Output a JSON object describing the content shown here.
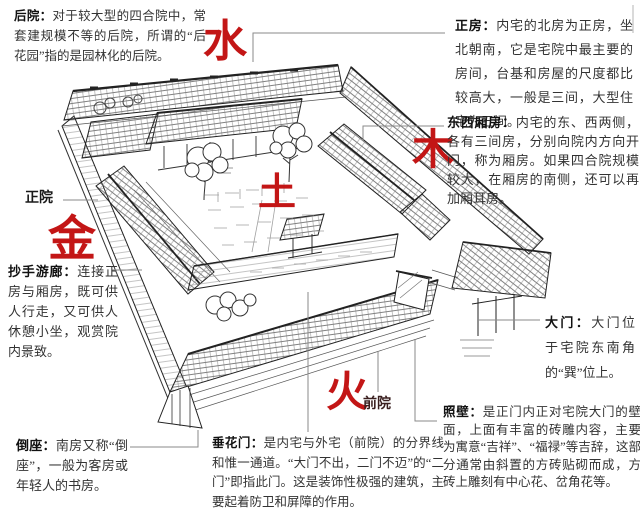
{
  "figure": {
    "subject": "四合院结构图解（鸟瞰手绘）",
    "ink_color": "#2b2b2b",
    "accent_red": "#c31616",
    "leader_color": "#8a8a8a"
  },
  "wuxing": {
    "water": "水",
    "wood": "木",
    "metal": "金",
    "earth": "土",
    "fire": "火"
  },
  "labels": {
    "main_courtyard": "正院",
    "front_courtyard": "前院"
  },
  "annotations": {
    "houyuan": {
      "term": "后院：",
      "text": "对于较大型的四合院中，常套建规模不等的后院，所谓的“后花园”指的是园林化的后院。"
    },
    "zhengfang": {
      "term": "正房：",
      "text": "内宅的北房为正房，坐北朝南，它是宅院中最主要的房间，台基和房屋的尺度都比较高大，一般是三间，大型住宅为五间。"
    },
    "xiangfang": {
      "term": "东西厢房：",
      "text": "内宅的东、西两侧，各有三间房，分别向院内方向开门，称为厢房。如果四合院规模较大，在厢房的南侧，还可以再加厢耳房。"
    },
    "youlang": {
      "term": "抄手游廊：",
      "text": "连接正房与厢房，既可供人行走，又可供人休憩小坐，观赏院内景致。"
    },
    "daozuo": {
      "term": "倒座：",
      "text": "南房又称“倒座”，一般为客房或年轻人的书房。"
    },
    "chuihuamen": {
      "term": "垂花门：",
      "text": "是内宅与外宅（前院）的分界线和惟一通道。“大门不出，二门不迈”的“二门”即指此门。这是装饰性极强的建筑，主要起着防卫和屏障的作用。"
    },
    "damen": {
      "term": "大门：",
      "text": "大门位于宅院东南角的“巽”位上。"
    },
    "zhaobi": {
      "term": "照壁：",
      "text": "是正门内正对宅院大门的壁面，上面有丰富的砖雕内容，主要为寓意“吉祥”、“福禄”等吉辞，这部分通常由斜置的方砖贴砌而成，方砖上雕刻有中心花、岔角花等。"
    }
  }
}
